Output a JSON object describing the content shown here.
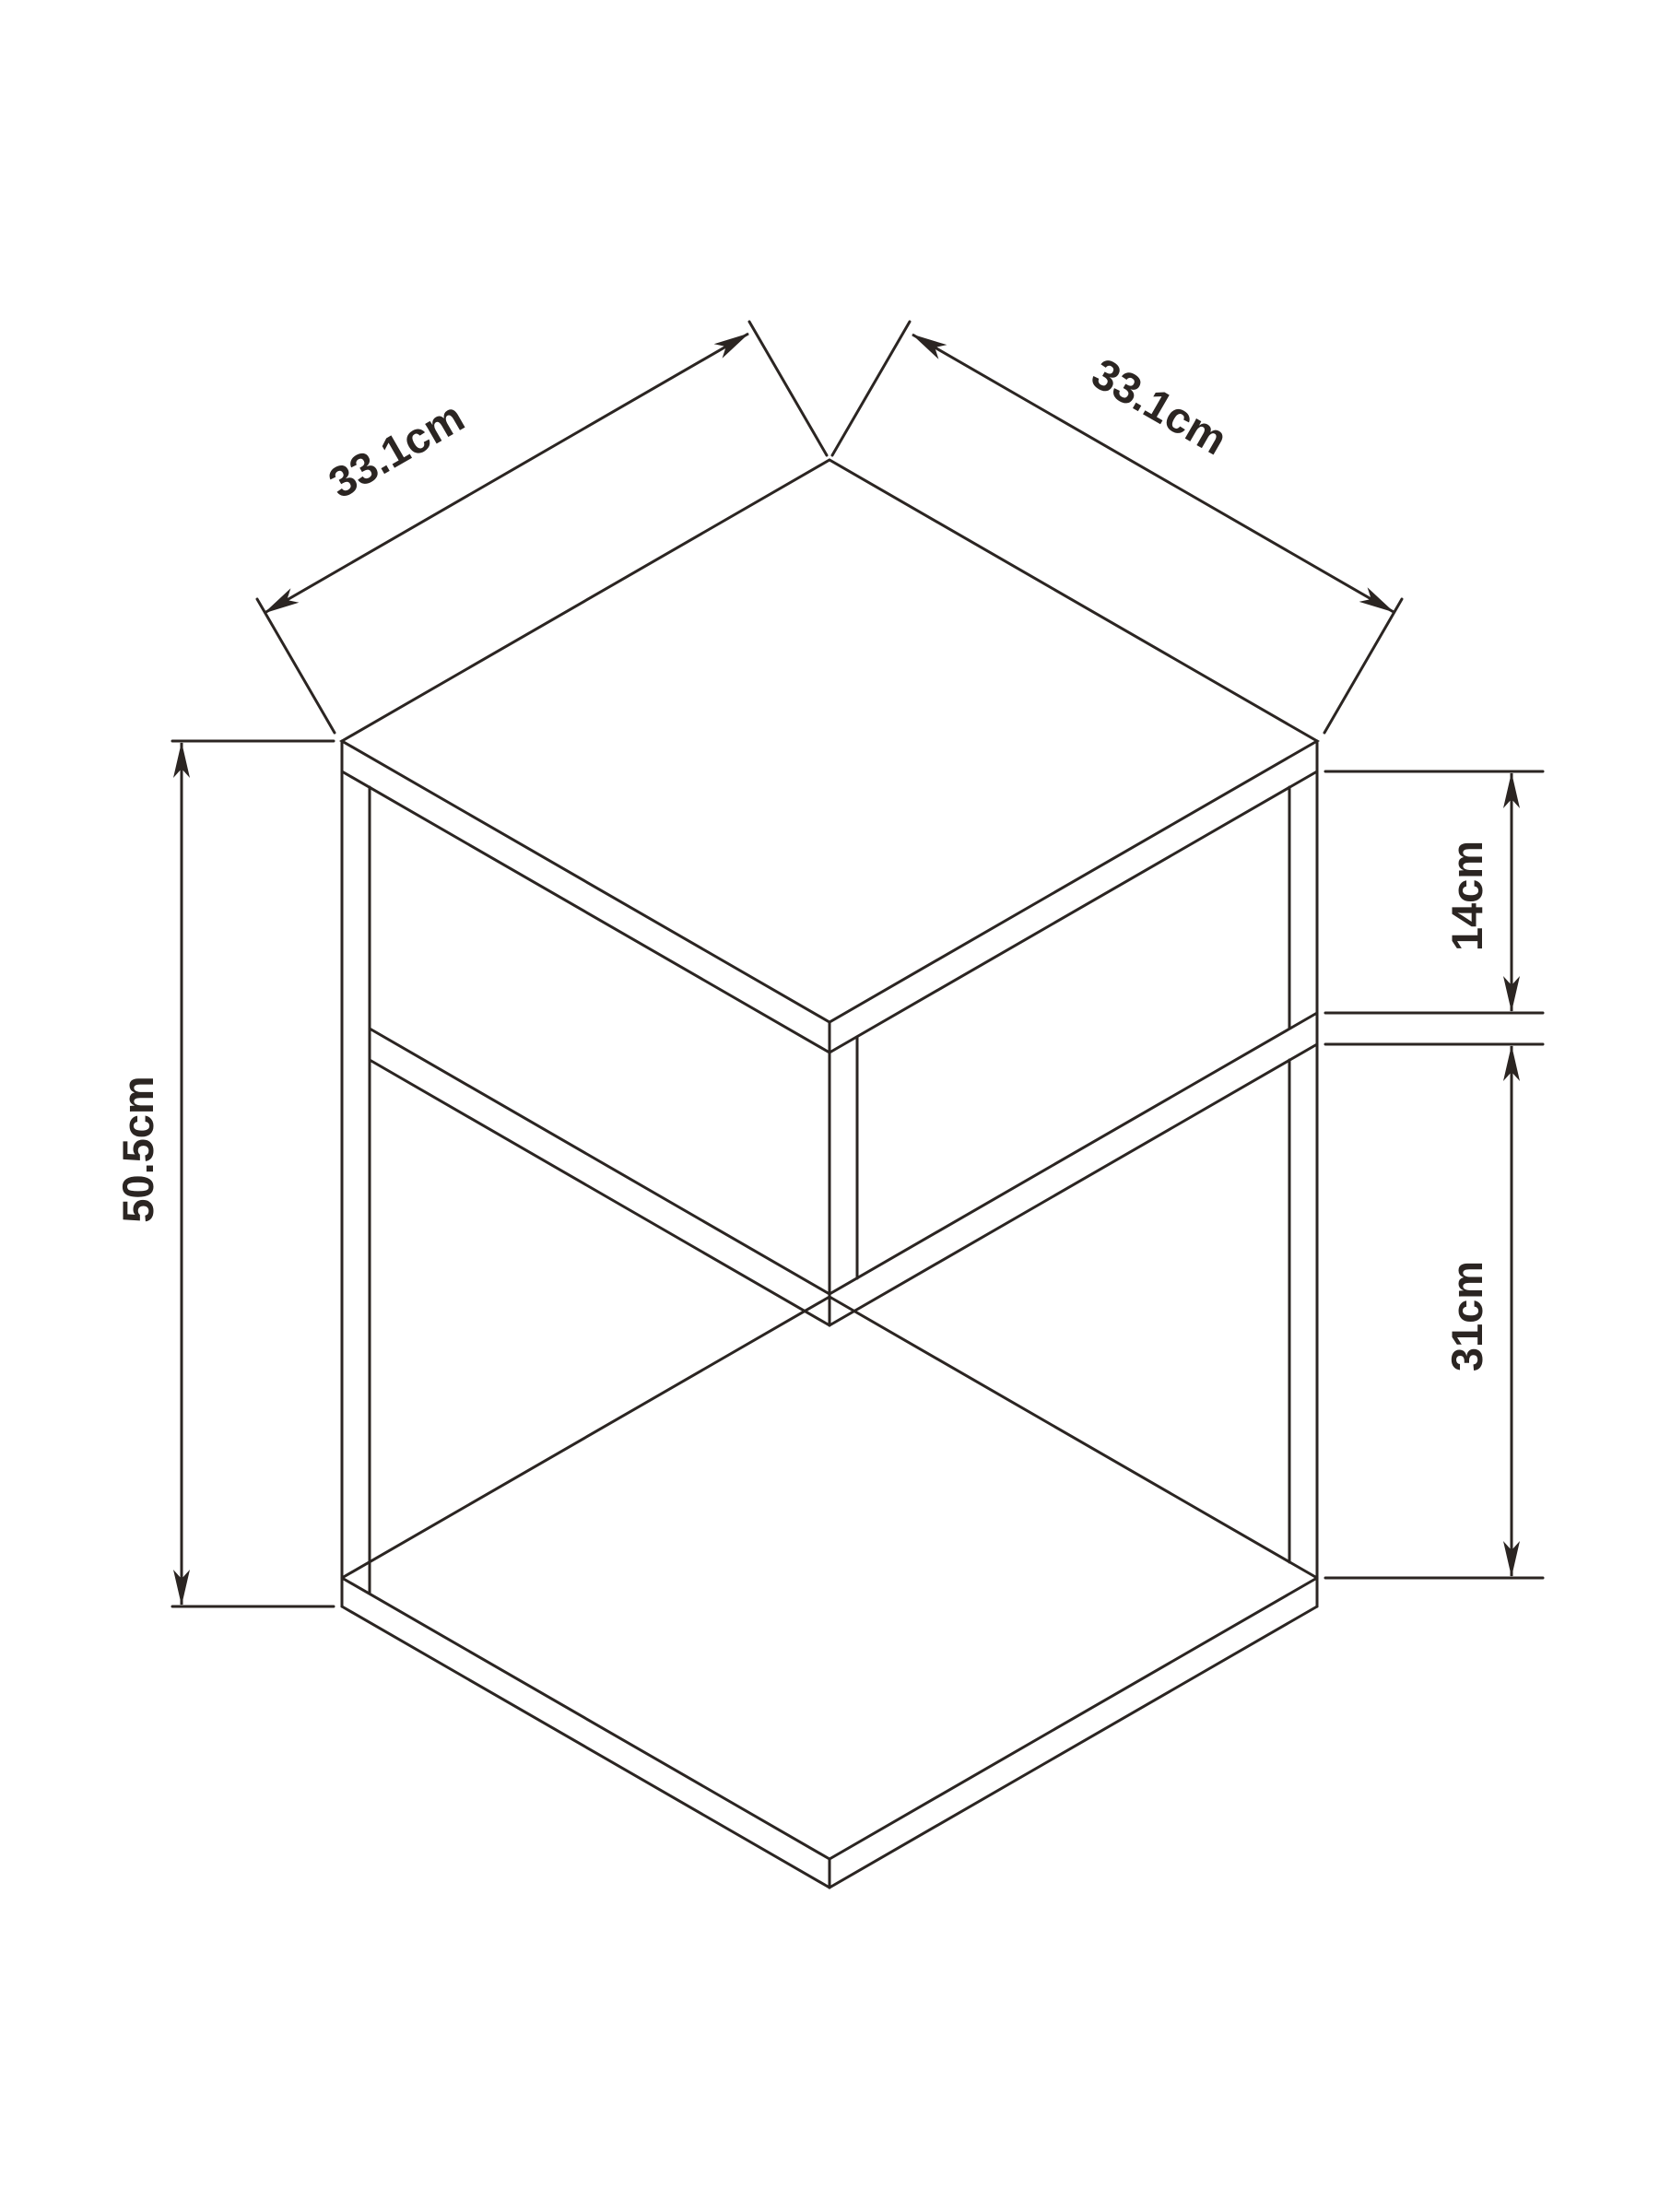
{
  "diagram": {
    "type": "furniture-dimension-drawing",
    "unit": "cm",
    "dimensions": {
      "top_left_width": {
        "label": "33.1cm",
        "value": 33.1
      },
      "top_right_depth": {
        "label": "33.1cm",
        "value": 33.1
      },
      "overall_height": {
        "label": "50.5cm",
        "value": 50.5
      },
      "upper_gap": {
        "label": "14cm",
        "value": 14
      },
      "lower_gap": {
        "label": "31cm",
        "value": 31
      }
    },
    "colors": {
      "line": "#2b2522",
      "background": "#ffffff"
    }
  }
}
